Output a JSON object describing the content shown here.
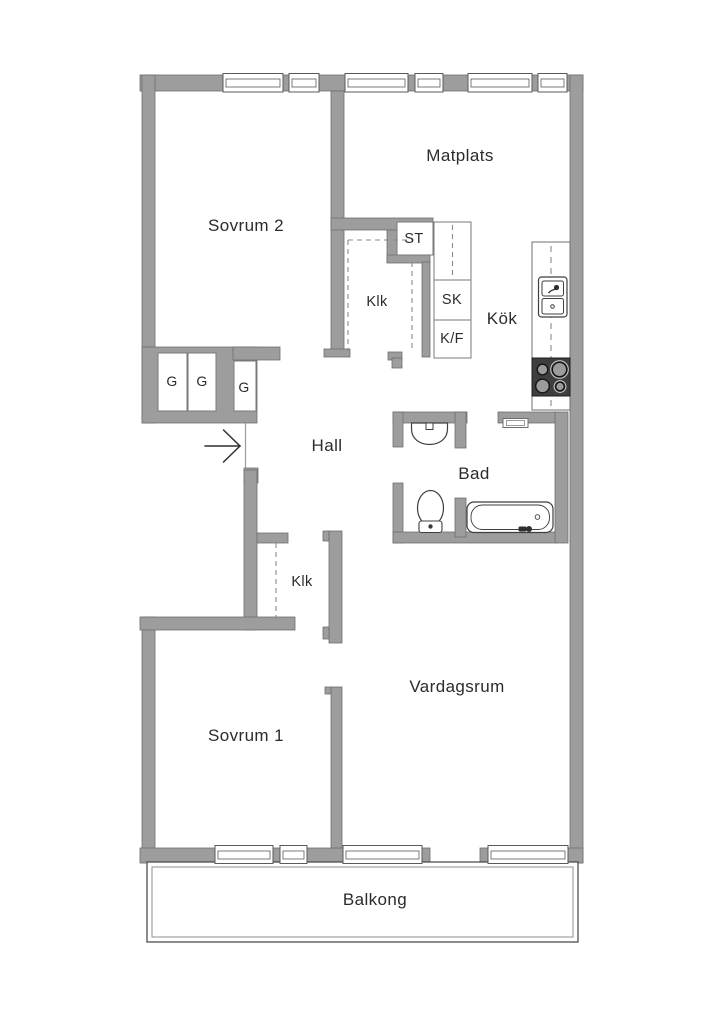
{
  "labels": {
    "sovrum2": "Sovrum 2",
    "matplats": "Matplats",
    "kok": "Kök",
    "hall": "Hall",
    "bad": "Bad",
    "sovrum1": "Sovrum 1",
    "vardagsrum": "Vardagsrum",
    "balkong": "Balkong",
    "klk_upper": "Klk",
    "klk_lower": "Klk",
    "st": "ST",
    "sk": "SK",
    "kf": "K/F",
    "g1": "G",
    "g2": "G",
    "g3": "G"
  },
  "colors": {
    "wall_fill": "#9d9d9d",
    "wall_outline": "#6f6f6f",
    "fixture_outline": "#3f3f3f",
    "stove_fill": "#3e3e3e",
    "text": "#2b2b2b",
    "background": "#ffffff"
  }
}
